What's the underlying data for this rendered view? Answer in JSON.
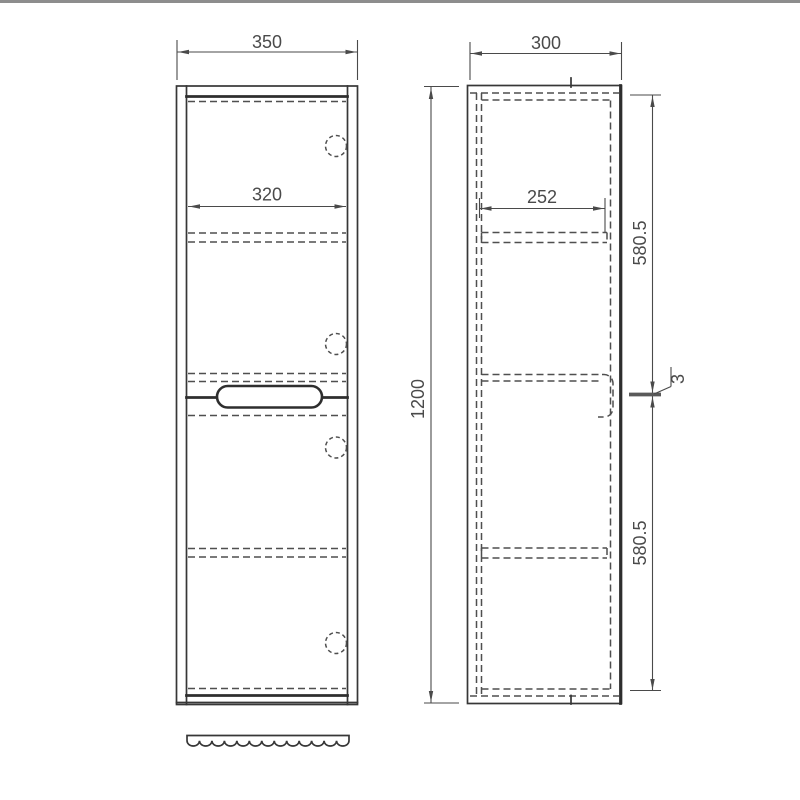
{
  "colors": {
    "background": "#ffffff",
    "top_edge": "#8d8d8d",
    "solid_line": "#373737",
    "dashed_line": "#4f4f4f",
    "dimension": "#4a4a4a"
  },
  "drawing": {
    "front_view": {
      "outer_width_label": "350",
      "door_width_label": "320"
    },
    "side_view": {
      "outer_depth_label": "300",
      "inner_depth_label": "252",
      "height_label": "1200",
      "upper_section_label": "580.5",
      "lower_section_label": "580.5",
      "gap_thickness_label": "3"
    }
  }
}
